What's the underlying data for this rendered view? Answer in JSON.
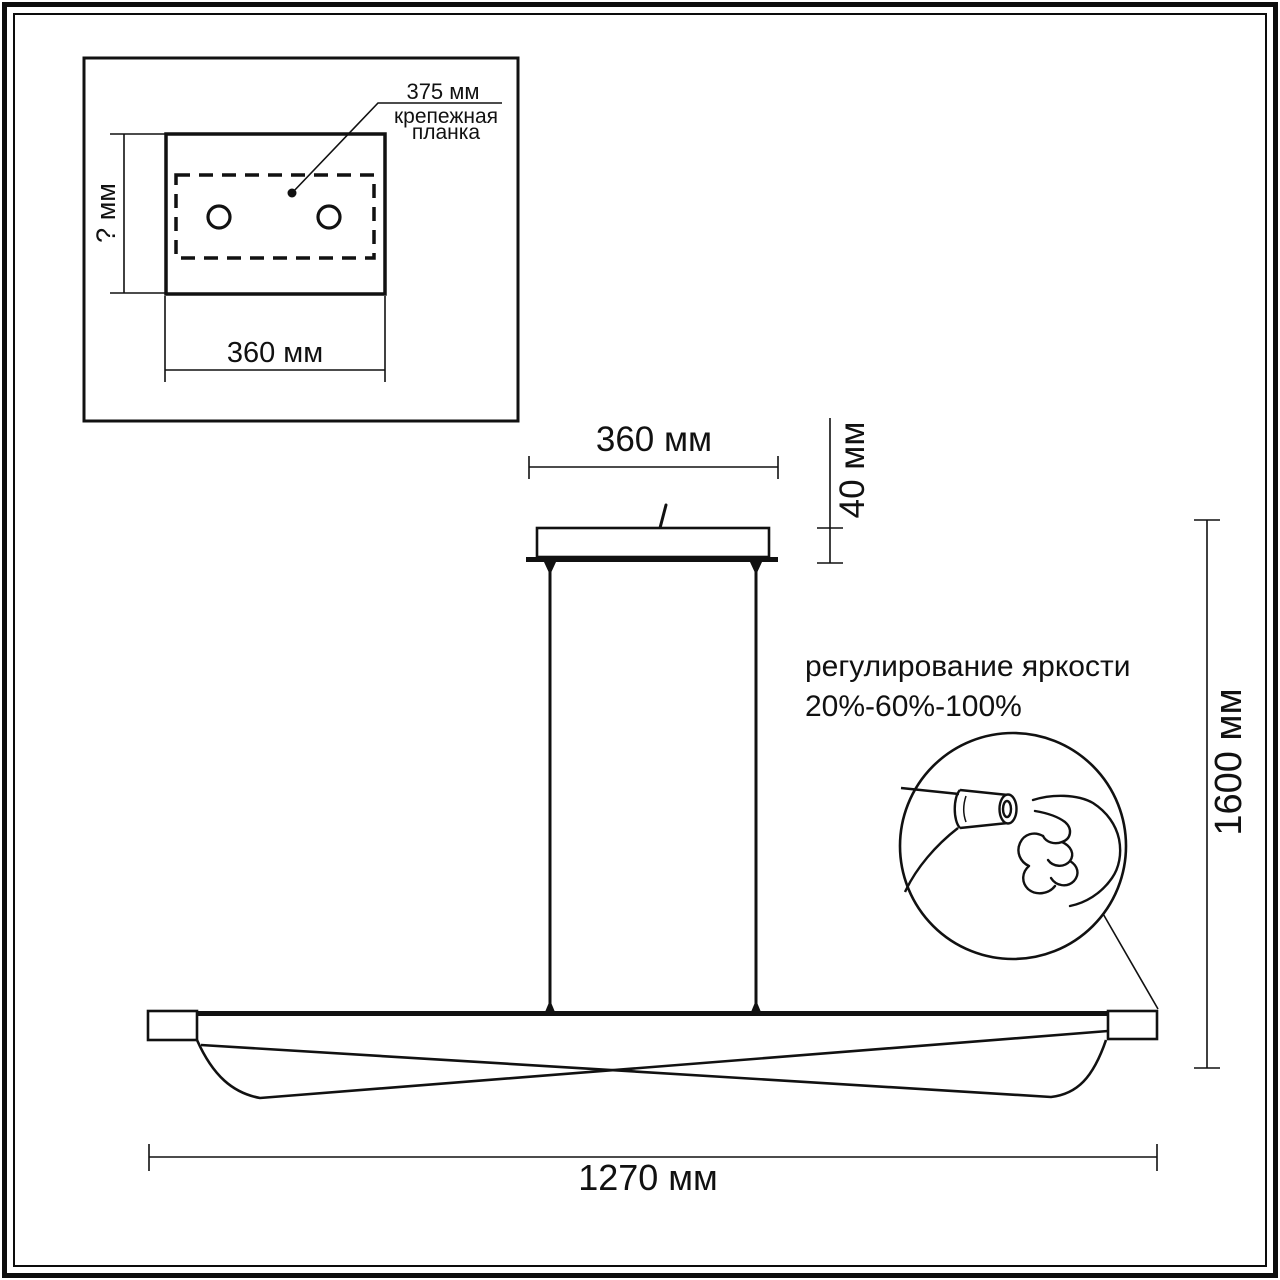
{
  "window": {
    "background": "#ffffff",
    "line_color": "#111111"
  },
  "inset": {
    "bracket_length": "375 мм",
    "bracket_name": "крепежная\nпланка",
    "height_dim": "? мм",
    "width_dim": "360 мм"
  },
  "pendant": {
    "canopy_width_dim": "360 мм",
    "canopy_height_dim": "40 мм",
    "suspension_height_dim": "1600 мм",
    "fixture_width_dim": "1270 мм"
  },
  "brightness": {
    "title": "регулирование яркости",
    "levels": "20%-60%-100%"
  }
}
